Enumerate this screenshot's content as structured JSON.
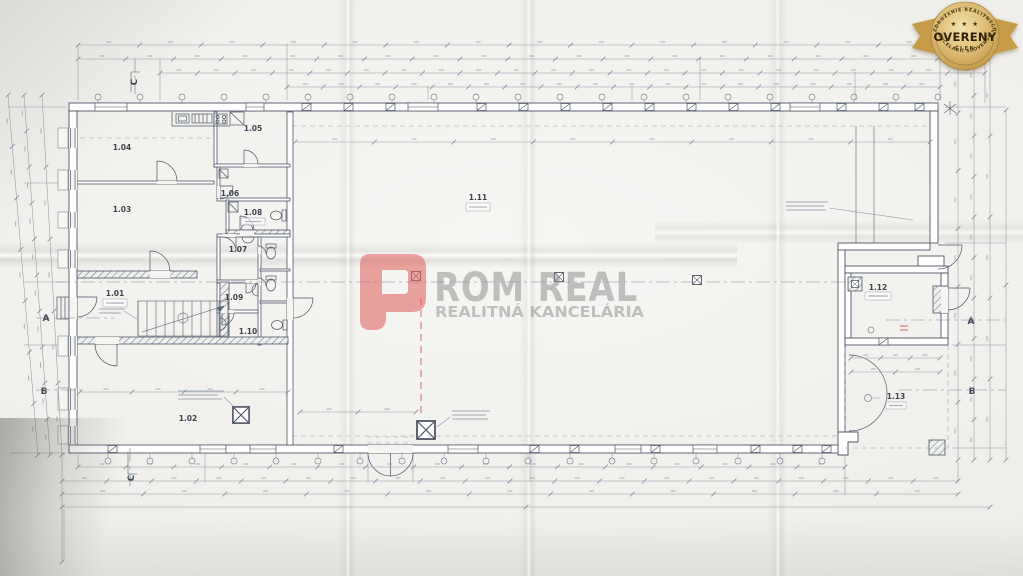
{
  "watermark": {
    "brand_full": "PROM REAL",
    "brand_rest": "ROM REAL",
    "tagline": "REALITNÁ KANCELÁRIA",
    "accent_color": "#df5f5b",
    "gray_color": "#8e8e8e"
  },
  "badge": {
    "arc_top": "ZDRUŽENIE REALITNÝCH",
    "stars": "★ ★ ★",
    "title": "OVERENÝ",
    "subtitle": "ČLEN",
    "arc_bottom": "KANCELÁRIÍ SLOVENSKA",
    "gold_color": "#cda55a",
    "text_color": "#2e2306"
  },
  "plan": {
    "rooms": [
      {
        "id": "1.01"
      },
      {
        "id": "1.02"
      },
      {
        "id": "1.03"
      },
      {
        "id": "1.04"
      },
      {
        "id": "1.05"
      },
      {
        "id": "1.06"
      },
      {
        "id": "1.07"
      },
      {
        "id": "1.08"
      },
      {
        "id": "1.09"
      },
      {
        "id": "1.10"
      },
      {
        "id": "1.11"
      },
      {
        "id": "1.12"
      },
      {
        "id": "1.13"
      }
    ],
    "sections": [
      {
        "label": "A"
      },
      {
        "label": "A"
      },
      {
        "label": "B"
      },
      {
        "label": "B"
      },
      {
        "label": "C"
      },
      {
        "label": "C"
      }
    ],
    "ink_color": "#4e5665",
    "dimension_color": "#7d8694",
    "red_marking_color": "#c4453c"
  }
}
